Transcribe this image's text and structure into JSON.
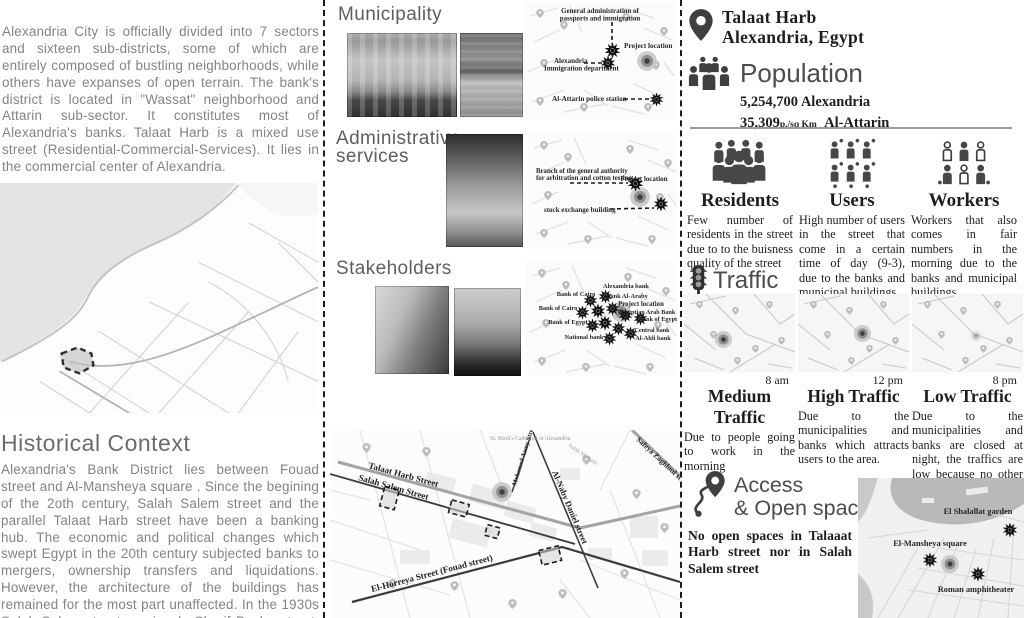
{
  "left": {
    "intro": "Alexandria City is officially divided into 7 sectors and sixteen sub-districts, some of which are entirely composed of bustling neighborhoods, while others have expanses of open terrain. The bank's district is located in \"Wassat\" neighborhood and Attarin sub-sector. It constitutes most of Alexandria's banks. Talaat Harb is a mixed use street (Residential-Commercial-Services). It lies in the commercial center of Alexandria.",
    "historical_title": "Historical Context",
    "historical_text": "Alexandria's Bank District lies between Fouad street and Al-Mansheya square . Since the begining of the 2oth century, Salah Salem street and the parallel Talaat Harb street have been a banking hub. The economic and political changes which swept Egypt in the 20th century subjected banks to mergers, ownership transfers and liquidations. However, the architecture of the buildings has remained for the most part unaffected. In the 1930s Salah Salem street previously Cherif Pasha street, had seven banks on each side."
  },
  "middle": {
    "municipality_title": "Municipality",
    "municipality_map": {
      "label_admin1": "General administration of",
      "label_admin2": "passports and immigration",
      "label_project": "Project location",
      "label_imm1": "Alexandria",
      "label_imm2": "Immigration department",
      "label_police": "Al-Attarin police station"
    },
    "admin_title_line1": "Administrative",
    "admin_title_line2": "services",
    "admin_map": {
      "label_branch1": "Branch of the general authority",
      "label_branch2": "for arbitration and cotton testing",
      "label_project": "Project location",
      "label_stock": "stock exchange building"
    },
    "stakeholders_title": "Stakeholders",
    "stakeholders_map": {
      "labels": [
        "Alexandria bank",
        "Bank of Cairo",
        "Bank Al-Araby",
        "Project location",
        "Egyptian Arab Bank",
        "Bank of Egypt",
        "Bank of Cairo",
        "Bank of Egypt",
        "Central bank",
        "Al-Ahli bank",
        "National bank"
      ]
    },
    "street_map": {
      "talaat": "Talaat Harb Street",
      "salah": "Salah Salem Street",
      "horreya": "El-Horreya Street (Fouad street)",
      "naby": "Al-Naby Daniel street",
      "azmy": "Mohamed Azmy Street",
      "safeya": "Safeya Zaghloul street",
      "poi_cathedral": "St. Mark's Cathedral in Alexandria",
      "poi_salah_mustafa": "Salah Mustafa"
    }
  },
  "right": {
    "place_title": "Talaat Harb",
    "place_subtitle": "Alexandria, Egypt",
    "population_title": "Population",
    "pop_stat1_value": "5,254,700",
    "pop_stat1_label": "Alexandria",
    "pop_stat2_value": "35,309",
    "pop_stat2_unit": "p./sq Km",
    "pop_stat2_label": "Al-Attarin",
    "groups": [
      {
        "name": "Residents",
        "text": "Few number of residents in the street due to to the buisness quality of the street"
      },
      {
        "name": "Users",
        "text": "High number of users in the street that come in a certain time of day (9-3), due to the banks and municipal buildings."
      },
      {
        "name": "Workers",
        "text": "Workers that also comes in fair numbers in the morning due to the banks and municipal buildings."
      }
    ],
    "traffic_title": "Traffic",
    "traffic": [
      {
        "time": "8 am",
        "level": "Medium Traffic",
        "text": "Due to people going to work in the morning"
      },
      {
        "time": "12 pm",
        "level": "High Traffic",
        "text": "Due to the municipalities and banks which attracts users to the area."
      },
      {
        "time": "8 pm",
        "level": "Low Traffic",
        "text": "Due to the municipalities and banks are closed at night, the traffics are low because no other attractions."
      }
    ],
    "access_title_line1": "Access",
    "access_title_line2": "& Open spaces",
    "access_text": "No open spaces in Talaaat Harb street nor in Salah Salem street",
    "access_map": {
      "garden": "El Shalallat garden",
      "square": "El-Mansheya square",
      "amphitheater": "Roman amphitheater"
    }
  },
  "icons": {
    "location_pin": "location-pin-icon",
    "population": "population-people-icon",
    "residents": "residents-crowd-icon",
    "users": "users-grid-icon",
    "workers": "workers-people-icon",
    "traffic": "traffic-light-icon",
    "access": "route-pin-icon",
    "marker": "star-burst-marker",
    "project": "bullseye-marker"
  },
  "colors": {
    "text_light": "#838383",
    "text_dark": "#1d1d1d",
    "divider": "#1c1c1c",
    "water": "#e4e4e4",
    "marker": "#101010"
  }
}
